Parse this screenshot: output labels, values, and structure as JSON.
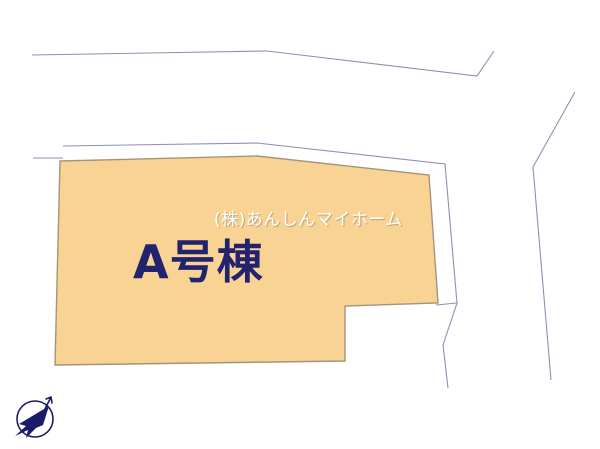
{
  "page": {
    "background": "#ffffff",
    "width": 600,
    "height": 449
  },
  "watermark": {
    "text": "(株)あんしんマイホーム",
    "color": "#ffffff"
  },
  "plot": {
    "label": "A号棟",
    "label_color": "#22226e",
    "fill": "#f8d394",
    "stroke": "#a5947b",
    "points": [
      [
        60,
        161
      ],
      [
        257,
        156
      ],
      [
        429,
        175
      ],
      [
        438,
        303
      ],
      [
        345,
        306
      ],
      [
        345,
        361
      ],
      [
        55,
        365
      ]
    ]
  },
  "boundary_lines": {
    "color": "#8f8fb5",
    "lines": [
      {
        "name": "road-line-top",
        "points": [
          [
            32,
            55
          ],
          [
            267,
            51
          ],
          [
            477,
            76
          ],
          [
            494,
            51
          ]
        ]
      },
      {
        "name": "road-line-right",
        "points": [
          [
            575,
            92
          ],
          [
            533,
            167
          ],
          [
            551,
            380
          ]
        ]
      },
      {
        "name": "road-stub-left",
        "points": [
          [
            33,
            158
          ],
          [
            63,
            158
          ]
        ]
      },
      {
        "name": "parcel-boundary",
        "points": [
          [
            63,
            146
          ],
          [
            257,
            143
          ],
          [
            445,
            164
          ],
          [
            457,
            303
          ],
          [
            443,
            345
          ],
          [
            448,
            388
          ]
        ]
      },
      {
        "name": "parcel-boundary-stub",
        "points": [
          [
            436,
            305
          ],
          [
            457,
            303
          ]
        ]
      }
    ]
  },
  "compass": {
    "color": "#1b1b6b"
  }
}
